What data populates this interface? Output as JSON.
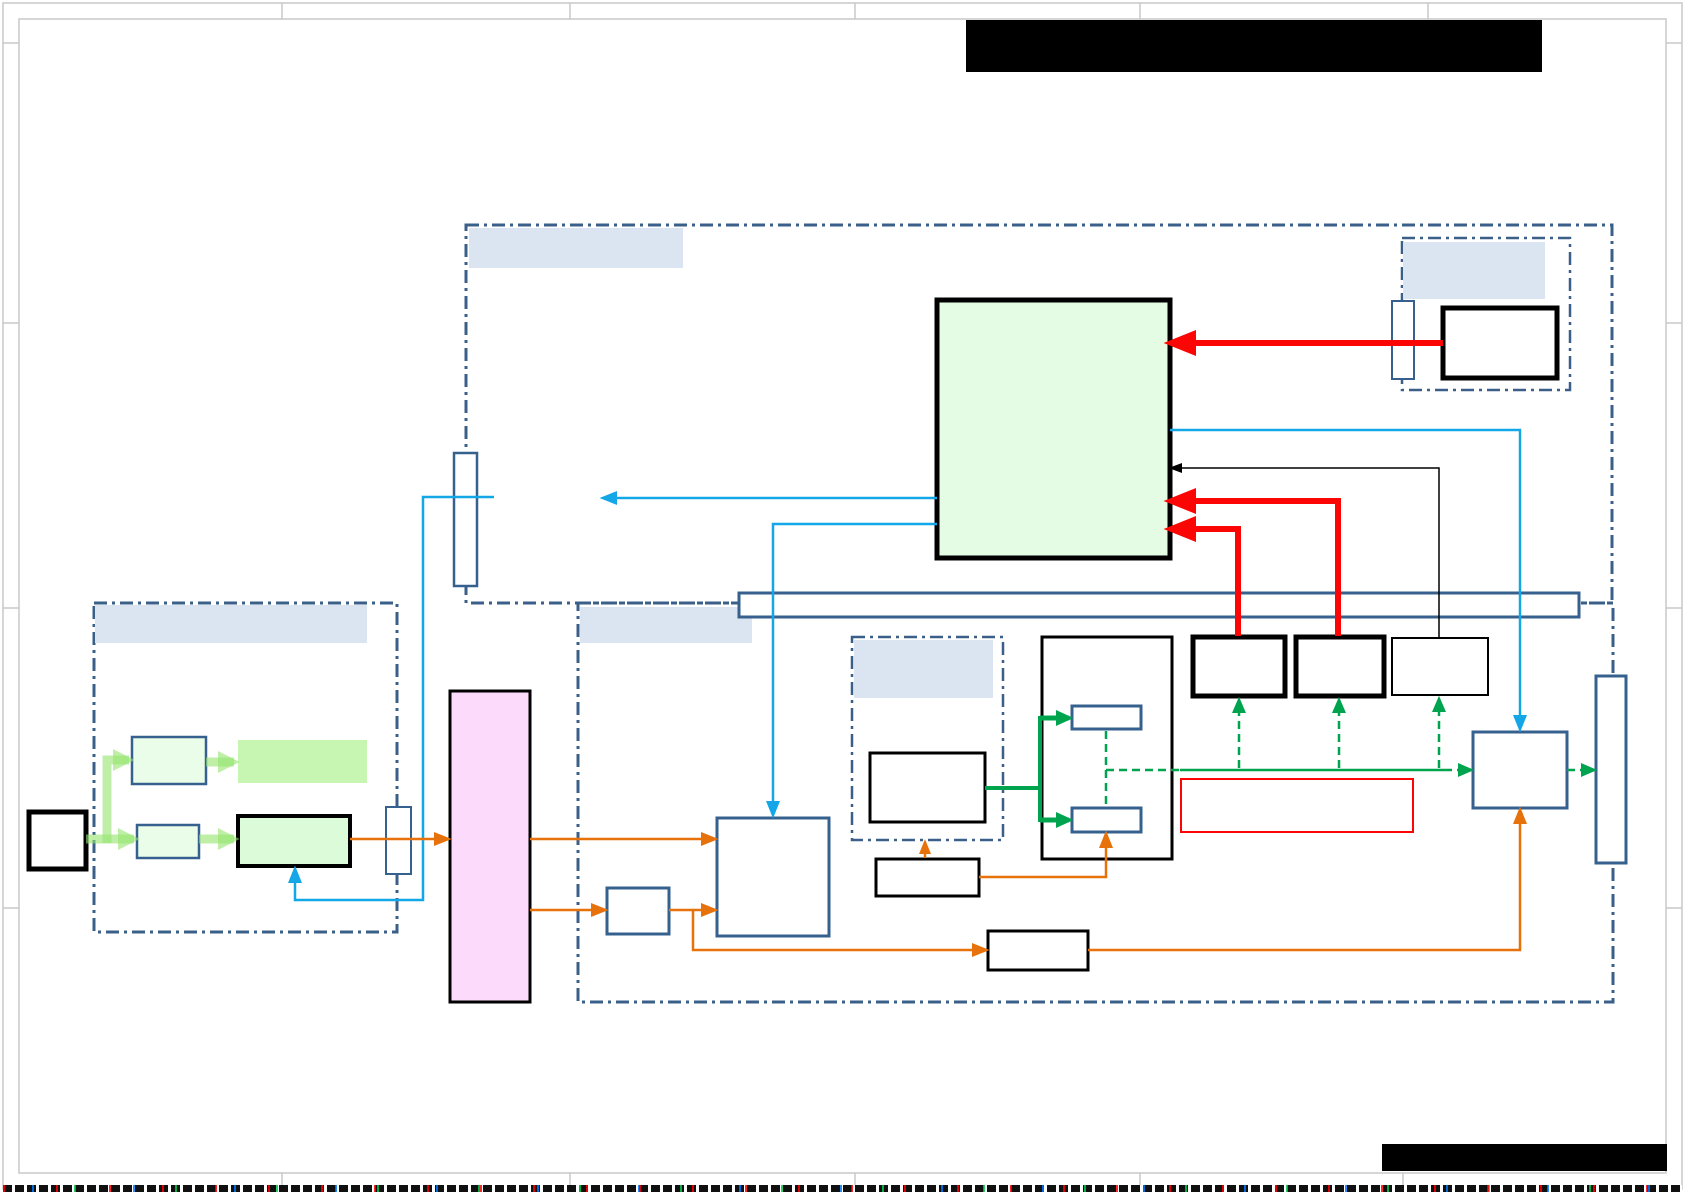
{
  "title": "Redacted system block diagram sheet",
  "canvas": {
    "width": 1685,
    "height": 1192,
    "background": "#ffffff"
  },
  "palette": {
    "region_border": "#3a5f88",
    "label_fill": "#dbe5f1",
    "steel_blue": "#36618f",
    "red": "#fb0505",
    "cyan": "#14a7e8",
    "orange": "#e7710b",
    "green": "#00a44f",
    "pale_green": "rgba(148,229,109,0.6)",
    "pink_fill": "#fcdafb",
    "light_green_fill": "#e3fce3",
    "box_green_fill": "#dcfbd8",
    "pale_box_fill": "#eafde8",
    "green_rect_fill": "#c7f6b3",
    "frame_gray": "#c9c9c9",
    "black": "#000000",
    "white": "#ffffff"
  },
  "frame": {
    "outer_inset": 3,
    "inner_inset": 19,
    "top_ticks": [
      282,
      570,
      855,
      1140,
      1428
    ],
    "bottom_ticks": [
      282,
      570,
      855,
      1140,
      1403
    ],
    "side_ticks": [
      43,
      323,
      608,
      908
    ]
  },
  "redactions": [
    {
      "name": "title-block-redaction",
      "x": 966,
      "y": 20,
      "w": 576,
      "h": 52
    },
    {
      "name": "footer-redaction",
      "x": 1382,
      "y": 1144,
      "w": 285,
      "h": 27
    }
  ],
  "regions": [
    {
      "name": "top-region",
      "x": 466,
      "y": 225,
      "w": 1146,
      "h": 378,
      "sw": 3
    },
    {
      "name": "bottom-region",
      "x": 578,
      "y": 603,
      "w": 1035,
      "h": 399,
      "sw": 3
    },
    {
      "name": "left-region",
      "x": 94,
      "y": 603,
      "w": 303,
      "h": 329,
      "sw": 3
    },
    {
      "name": "top-right-region",
      "x": 1402,
      "y": 238,
      "w": 168,
      "h": 152,
      "sw": 2.5
    },
    {
      "name": "inner-region",
      "x": 852,
      "y": 637,
      "w": 151,
      "h": 203,
      "sw": 2.5
    }
  ],
  "labels": [
    {
      "name": "top-region-label",
      "x": 469,
      "y": 228,
      "w": 214,
      "h": 40
    },
    {
      "name": "bottom-region-label",
      "x": 580,
      "y": 607,
      "w": 172,
      "h": 36
    },
    {
      "name": "left-region-label",
      "x": 95,
      "y": 605,
      "w": 272,
      "h": 38
    },
    {
      "name": "top-right-region-label",
      "x": 1403,
      "y": 242,
      "w": 142,
      "h": 57
    },
    {
      "name": "inner-region-label",
      "x": 854,
      "y": 640,
      "w": 139,
      "h": 58
    }
  ],
  "nodes": [
    {
      "name": "bus-bar",
      "x": 739,
      "y": 593,
      "w": 840,
      "h": 24,
      "fill": "#ffffff",
      "stroke": "#36618f",
      "sw": 3
    },
    {
      "name": "main-green-block",
      "x": 937,
      "y": 300,
      "w": 233,
      "h": 258,
      "fill": "#e3fce3",
      "stroke": "#000000",
      "sw": 5
    },
    {
      "name": "top-right-black-box",
      "x": 1443,
      "y": 308,
      "w": 114,
      "h": 70,
      "fill": "#ffffff",
      "stroke": "#000000",
      "sw": 5
    },
    {
      "name": "top-right-port",
      "x": 1392,
      "y": 301,
      "w": 22,
      "h": 78,
      "fill": "#ffffff",
      "stroke": "#36618f",
      "sw": 2
    },
    {
      "name": "top-port",
      "x": 454,
      "y": 453,
      "w": 23,
      "h": 133,
      "fill": "#ffffff",
      "stroke": "#36618f",
      "sw": 2.5
    },
    {
      "name": "left-input-black-box",
      "x": 29,
      "y": 812,
      "w": 57,
      "h": 57,
      "fill": "#ffffff",
      "stroke": "#000000",
      "sw": 5
    },
    {
      "name": "left-box-upper",
      "x": 132,
      "y": 737,
      "w": 74,
      "h": 47,
      "fill": "#eafde8",
      "stroke": "#36618f",
      "sw": 2.5
    },
    {
      "name": "left-box-lower",
      "x": 137,
      "y": 825,
      "w": 62,
      "h": 33,
      "fill": "#eafde8",
      "stroke": "#36618f",
      "sw": 2.5
    },
    {
      "name": "left-green-rect",
      "x": 238,
      "y": 740,
      "w": 129,
      "h": 43,
      "fill": "#c7f6b3",
      "stroke": "none",
      "sw": 0
    },
    {
      "name": "left-green-black-box",
      "x": 238,
      "y": 816,
      "w": 112,
      "h": 50,
      "fill": "#dcfbd8",
      "stroke": "#000000",
      "sw": 4
    },
    {
      "name": "left-region-port",
      "x": 386,
      "y": 807,
      "w": 25,
      "h": 67,
      "fill": "#ffffff",
      "stroke": "#36618f",
      "sw": 2
    },
    {
      "name": "pink-block",
      "x": 450,
      "y": 691,
      "w": 80,
      "h": 311,
      "fill": "#fcdafb",
      "stroke": "#000000",
      "sw": 3
    },
    {
      "name": "small-blue-box",
      "x": 607,
      "y": 888,
      "w": 62,
      "h": 46,
      "fill": "#ffffff",
      "stroke": "#36618f",
      "sw": 3
    },
    {
      "name": "big-blue-box",
      "x": 717,
      "y": 818,
      "w": 112,
      "h": 118,
      "fill": "#ffffff",
      "stroke": "#36618f",
      "sw": 3
    },
    {
      "name": "inner-black-box",
      "x": 870,
      "y": 753,
      "w": 115,
      "h": 69,
      "fill": "#ffffff",
      "stroke": "#000000",
      "sw": 3
    },
    {
      "name": "middle-black-box",
      "x": 876,
      "y": 859,
      "w": 103,
      "h": 37,
      "fill": "#ffffff",
      "stroke": "#000000",
      "sw": 3
    },
    {
      "name": "bottom-black-box",
      "x": 988,
      "y": 931,
      "w": 100,
      "h": 39,
      "fill": "#ffffff",
      "stroke": "#000000",
      "sw": 3
    },
    {
      "name": "tall-black-box",
      "x": 1042,
      "y": 637,
      "w": 130,
      "h": 222,
      "fill": "#ffffff",
      "stroke": "#000000",
      "sw": 3
    },
    {
      "name": "tall-box-blue-top",
      "x": 1072,
      "y": 706,
      "w": 69,
      "h": 23,
      "fill": "#ffffff",
      "stroke": "#36618f",
      "sw": 3
    },
    {
      "name": "tall-box-blue-bottom",
      "x": 1072,
      "y": 808,
      "w": 69,
      "h": 24,
      "fill": "#ffffff",
      "stroke": "#36618f",
      "sw": 3
    },
    {
      "name": "row-box-a",
      "x": 1193,
      "y": 637,
      "w": 92,
      "h": 59,
      "fill": "#ffffff",
      "stroke": "#000000",
      "sw": 5
    },
    {
      "name": "row-box-b",
      "x": 1296,
      "y": 637,
      "w": 88,
      "h": 59,
      "fill": "#ffffff",
      "stroke": "#000000",
      "sw": 5
    },
    {
      "name": "row-box-c",
      "x": 1392,
      "y": 638,
      "w": 96,
      "h": 57,
      "fill": "#ffffff",
      "stroke": "#000000",
      "sw": 2
    },
    {
      "name": "red-outline-box",
      "x": 1181,
      "y": 779,
      "w": 232,
      "h": 53,
      "fill": "#ffffff",
      "stroke": "#fb0505",
      "sw": 2
    },
    {
      "name": "right-blue-box",
      "x": 1473,
      "y": 732,
      "w": 94,
      "h": 76,
      "fill": "#ffffff",
      "stroke": "#36618f",
      "sw": 3
    },
    {
      "name": "right-port",
      "x": 1596,
      "y": 676,
      "w": 30,
      "h": 187,
      "fill": "#ffffff",
      "stroke": "#36618f",
      "sw": 3
    }
  ],
  "edges": [
    {
      "name": "red-arrow-top",
      "color": "#fb0505",
      "width": 6,
      "points": [
        [
          1443,
          343
        ],
        [
          1172,
          343
        ]
      ],
      "arrow": true,
      "head": [
        24,
        13
      ]
    },
    {
      "name": "red-arrow-mid",
      "color": "#fb0505",
      "width": 6,
      "points": [
        [
          1338,
          636
        ],
        [
          1338,
          501
        ],
        [
          1172,
          501
        ]
      ],
      "arrow": true,
      "head": [
        24,
        13
      ]
    },
    {
      "name": "red-arrow-low",
      "color": "#fb0505",
      "width": 6,
      "points": [
        [
          1238,
          636
        ],
        [
          1238,
          529
        ],
        [
          1172,
          529
        ]
      ],
      "arrow": true,
      "head": [
        24,
        13
      ]
    },
    {
      "name": "black-feedback-arrow",
      "color": "#000000",
      "width": 1.5,
      "points": [
        [
          1439,
          637
        ],
        [
          1439,
          468
        ],
        [
          1172,
          468
        ]
      ],
      "arrow": true,
      "head": [
        10,
        5
      ]
    },
    {
      "name": "cyan-right-drop",
      "color": "#14a7e8",
      "width": 2.5,
      "points": [
        [
          1170,
          430
        ],
        [
          1520,
          430
        ],
        [
          1520,
          728
        ]
      ],
      "arrow": true,
      "head": [
        13,
        7
      ]
    },
    {
      "name": "cyan-dangling-arrow",
      "color": "#14a7e8",
      "width": 2.5,
      "points": [
        [
          937,
          498
        ],
        [
          604,
          498
        ]
      ],
      "arrow": true,
      "head": [
        13,
        7
      ]
    },
    {
      "name": "cyan-mid-drop",
      "color": "#14a7e8",
      "width": 2.5,
      "points": [
        [
          937,
          524
        ],
        [
          773,
          524
        ],
        [
          773,
          814
        ]
      ],
      "arrow": true,
      "head": [
        13,
        7
      ]
    },
    {
      "name": "cyan-left-loop",
      "color": "#14a7e8",
      "width": 2.5,
      "points": [
        [
          494,
          497
        ],
        [
          423,
          497
        ],
        [
          423,
          900
        ],
        [
          295,
          900
        ],
        [
          295,
          870
        ]
      ],
      "arrow": true,
      "head": [
        13,
        7
      ]
    },
    {
      "name": "orange-to-pink",
      "color": "#e7710b",
      "width": 2.5,
      "points": [
        [
          350,
          839
        ],
        [
          447,
          839
        ]
      ],
      "arrow": true,
      "head": [
        13,
        7
      ]
    },
    {
      "name": "orange-pink-to-bigblue",
      "color": "#e7710b",
      "width": 2.5,
      "points": [
        [
          530,
          839
        ],
        [
          714,
          839
        ]
      ],
      "arrow": true,
      "head": [
        13,
        7
      ]
    },
    {
      "name": "orange-pink-to-small",
      "color": "#e7710b",
      "width": 2.5,
      "points": [
        [
          530,
          910
        ],
        [
          604,
          910
        ]
      ],
      "arrow": true,
      "head": [
        13,
        7
      ]
    },
    {
      "name": "orange-small-to-bigblue",
      "color": "#e7710b",
      "width": 2.5,
      "points": [
        [
          669,
          910
        ],
        [
          714,
          910
        ]
      ],
      "arrow": true,
      "head": [
        13,
        7
      ]
    },
    {
      "name": "orange-branch-to-bottom-box",
      "color": "#e7710b",
      "width": 2.5,
      "points": [
        [
          693,
          911
        ],
        [
          693,
          950
        ],
        [
          985,
          950
        ]
      ],
      "arrow": true,
      "head": [
        13,
        7
      ]
    },
    {
      "name": "orange-bottom-to-rightblue",
      "color": "#e7710b",
      "width": 2.5,
      "points": [
        [
          1088,
          950
        ],
        [
          1520,
          950
        ],
        [
          1520,
          811
        ]
      ],
      "arrow": true,
      "head": [
        13,
        7
      ]
    },
    {
      "name": "orange-middle-to-tallbox",
      "color": "#e7710b",
      "width": 2.5,
      "points": [
        [
          979,
          877
        ],
        [
          1106,
          877
        ],
        [
          1106,
          835
        ]
      ],
      "arrow": true,
      "head": [
        13,
        7
      ]
    },
    {
      "name": "orange-middle-up-stub",
      "color": "#e7710b",
      "width": 2.5,
      "points": [
        [
          925,
          858
        ],
        [
          925,
          843
        ]
      ],
      "arrow": true,
      "head": [
        11,
        6
      ]
    },
    {
      "name": "green-from-inner-box",
      "color": "#00a44f",
      "width": 4,
      "points": [
        [
          985,
          788
        ],
        [
          1040,
          788
        ]
      ],
      "arrow": false
    },
    {
      "name": "green-split-vertical",
      "color": "#00a44f",
      "width": 4,
      "points": [
        [
          1040,
          716
        ],
        [
          1040,
          822
        ]
      ],
      "arrow": false
    },
    {
      "name": "green-to-blue-top",
      "color": "#00a44f",
      "width": 5,
      "points": [
        [
          1040,
          718
        ],
        [
          1069,
          718
        ]
      ],
      "arrow": true,
      "head": [
        13,
        8
      ]
    },
    {
      "name": "green-to-blue-bottom",
      "color": "#00a44f",
      "width": 5,
      "points": [
        [
          1040,
          820
        ],
        [
          1069,
          820
        ]
      ],
      "arrow": true,
      "head": [
        13,
        8
      ]
    },
    {
      "name": "green-solid-rail",
      "color": "#00a44f",
      "width": 2.5,
      "points": [
        [
          1180,
          770
        ],
        [
          1444,
          770
        ]
      ],
      "arrow": false
    },
    {
      "name": "green-dashed-vertical",
      "color": "#00a44f",
      "width": 2.5,
      "dash": "8 5",
      "points": [
        [
          1106,
          731
        ],
        [
          1106,
          806
        ]
      ],
      "arrow": false
    },
    {
      "name": "green-dashed-horiz",
      "color": "#00a44f",
      "width": 2.5,
      "dash": "8 5",
      "points": [
        [
          1106,
          770
        ],
        [
          1180,
          770
        ]
      ],
      "arrow": false
    },
    {
      "name": "green-dashed-to-box-a",
      "color": "#00a44f",
      "width": 2.5,
      "dash": "8 5",
      "points": [
        [
          1239,
          768
        ],
        [
          1239,
          701
        ]
      ],
      "arrow": true,
      "head": [
        12,
        7
      ]
    },
    {
      "name": "green-dashed-to-box-b",
      "color": "#00a44f",
      "width": 2.5,
      "dash": "8 5",
      "points": [
        [
          1339,
          768
        ],
        [
          1339,
          701
        ]
      ],
      "arrow": true,
      "head": [
        12,
        7
      ]
    },
    {
      "name": "green-dashed-to-box-c",
      "color": "#00a44f",
      "width": 2.5,
      "dash": "8 5",
      "points": [
        [
          1439,
          768
        ],
        [
          1439,
          700
        ]
      ],
      "arrow": true,
      "head": [
        12,
        7
      ]
    },
    {
      "name": "green-dashed-to-rightblue",
      "color": "#00a44f",
      "width": 2.5,
      "dash": "8 5",
      "points": [
        [
          1444,
          770
        ],
        [
          1470,
          770
        ]
      ],
      "arrow": true,
      "head": [
        12,
        7
      ]
    },
    {
      "name": "green-dashed-to-port",
      "color": "#00a44f",
      "width": 2.5,
      "dash": "8 5",
      "points": [
        [
          1567,
          770
        ],
        [
          1593,
          770
        ]
      ],
      "arrow": true,
      "head": [
        12,
        7
      ]
    },
    {
      "name": "pale-green-stem",
      "color": "rgba(148,229,109,0.6)",
      "width": 9,
      "points": [
        [
          86,
          839
        ],
        [
          110,
          839
        ]
      ],
      "arrow": false
    },
    {
      "name": "pale-green-up-branch",
      "color": "rgba(148,229,109,0.6)",
      "width": 9,
      "points": [
        [
          107,
          843
        ],
        [
          107,
          760
        ],
        [
          129,
          760
        ]
      ],
      "arrow": true,
      "head": [
        16,
        11
      ]
    },
    {
      "name": "pale-green-lower-branch",
      "color": "rgba(148,229,109,0.6)",
      "width": 9,
      "points": [
        [
          110,
          839
        ],
        [
          134,
          839
        ]
      ],
      "arrow": true,
      "head": [
        16,
        11
      ]
    },
    {
      "name": "pale-green-to-rect",
      "color": "rgba(148,229,109,0.6)",
      "width": 9,
      "points": [
        [
          206,
          762
        ],
        [
          234,
          762
        ]
      ],
      "arrow": true,
      "head": [
        16,
        11
      ]
    },
    {
      "name": "pale-green-to-blackbox",
      "color": "rgba(148,229,109,0.6)",
      "width": 9,
      "points": [
        [
          199,
          839
        ],
        [
          234,
          839
        ]
      ],
      "arrow": true,
      "head": [
        16,
        11
      ]
    }
  ]
}
